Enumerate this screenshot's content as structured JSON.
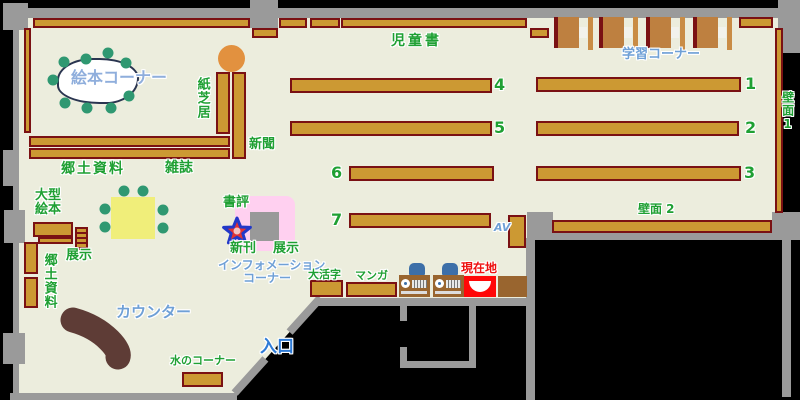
{
  "labels": {
    "picture_book_corner": "絵本コーナー",
    "kamishibai": "紙芝居",
    "newspaper": "新聞",
    "local_materials_top": "郷土資料",
    "magazines": "雑誌",
    "children_books": "児童書",
    "study_corner": "学習コーナー",
    "wall_face_1": "壁面1",
    "wall_face_2": "壁面 2",
    "large_picture_books": "大型絵本",
    "display_left": "展示",
    "local_materials_left": "郷土資料",
    "book_review": "書評",
    "new_arrivals": "新刊",
    "display_info": "展示",
    "information_line1": "インフォメーション",
    "information_line2": "コーナー",
    "large_print": "大活字",
    "manga": "マンガ",
    "current_location": "現在地",
    "counter": "カウンター",
    "water_corner": "水のコーナー",
    "entrance": "入口",
    "av": "AV"
  },
  "shelf_numbers": [
    "1",
    "2",
    "3",
    "4",
    "5",
    "6",
    "7"
  ],
  "colors": {
    "floor": "#ECEDDD",
    "wall": "#9A9A9A",
    "shelf": "#CC9933",
    "shelf-border": "#7A1113",
    "desk": "#BE8040",
    "desk-strip": "#C98C45",
    "machine": "#99652F",
    "chair": "#3D6FA8",
    "counter": "#5E3C36",
    "table": "#F0EE7A",
    "stool": "#2F9871",
    "orange": "#E2913F",
    "pink": "#FFD0F0",
    "gray-square": "#999999",
    "green": "#1FA033",
    "blue": "#6FA0D6",
    "light-blue": "#8FAEDC",
    "entry-blue": "#2E7BD6",
    "red": "#EE1111",
    "marker-red": "#FF0808",
    "star-fill": "#E23333",
    "star-stroke": "#2238C8",
    "blob-border": "#2A3550"
  }
}
